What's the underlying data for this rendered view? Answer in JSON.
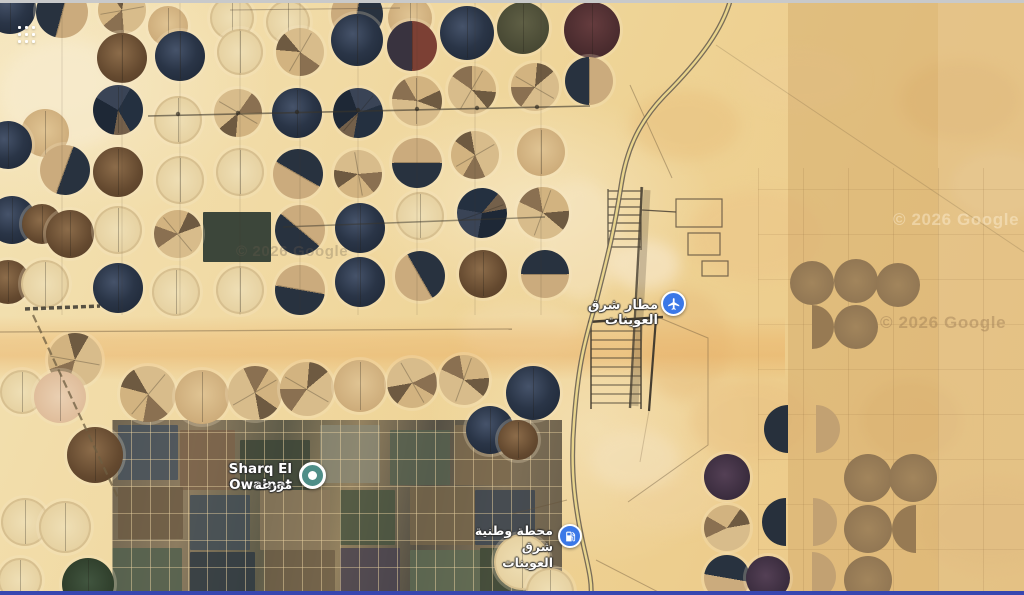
{
  "map": {
    "labels": {
      "farm_title": "Sharq El Owainat",
      "farm_subtitle_ar": "مزرعة",
      "airport_ar": "مطار شرق العوينات",
      "station_line1_ar": "محطة وطنية",
      "station_line2_ar": "شرق العوينات"
    },
    "attribution": "© 2026 Google",
    "colors": {
      "marker_blue": "#3b78e7",
      "marker_teal": "#4f8e88",
      "road_fill": "#e8d48c",
      "sand_base": "#f0d9a6",
      "bottom_bar": "#3847b0"
    },
    "circles": [
      [
        10,
        8,
        26,
        "navy",
        0
      ],
      [
        62,
        12,
        26,
        "half",
        15
      ],
      [
        122,
        10,
        24,
        "tanstreak",
        80
      ],
      [
        168,
        26,
        20,
        "tan",
        0
      ],
      [
        232,
        18,
        22,
        "pale",
        0
      ],
      [
        288,
        22,
        22,
        "pale",
        0
      ],
      [
        357,
        14,
        26,
        "half",
        190
      ],
      [
        410,
        18,
        22,
        "tan",
        0
      ],
      [
        467,
        33,
        27,
        "navy",
        0
      ],
      [
        523,
        28,
        26,
        "olive",
        0
      ],
      [
        592,
        30,
        28,
        "maroon",
        0
      ],
      [
        122,
        58,
        25,
        "brown",
        0
      ],
      [
        180,
        56,
        25,
        "navy",
        0
      ],
      [
        240,
        52,
        23,
        "pale",
        0
      ],
      [
        300,
        52,
        24,
        "tanstreak",
        30
      ],
      [
        357,
        40,
        26,
        "navy",
        0
      ],
      [
        412,
        46,
        25,
        "redhalf",
        0
      ],
      [
        472,
        90,
        24,
        "tanstreak",
        210
      ],
      [
        535,
        87,
        24,
        "tanstreak",
        120
      ],
      [
        589,
        81,
        24,
        "half",
        0
      ],
      [
        118,
        110,
        25,
        "navy2",
        0
      ],
      [
        178,
        120,
        24,
        "pale",
        0
      ],
      [
        238,
        113,
        24,
        "tanstreak",
        300
      ],
      [
        297,
        113,
        25,
        "navy",
        0
      ],
      [
        358,
        113,
        25,
        "navy2",
        40
      ],
      [
        417,
        101,
        25,
        "tanstreak",
        180
      ],
      [
        45,
        133,
        24,
        "tan",
        0
      ],
      [
        8,
        145,
        24,
        "navy",
        0
      ],
      [
        65,
        170,
        25,
        "half",
        200
      ],
      [
        118,
        172,
        25,
        "brown",
        0
      ],
      [
        180,
        180,
        24,
        "pale",
        0
      ],
      [
        240,
        172,
        24,
        "pale",
        0
      ],
      [
        298,
        174,
        25,
        "half",
        120
      ],
      [
        358,
        174,
        24,
        "tanstreak",
        350
      ],
      [
        417,
        163,
        25,
        "half",
        270
      ],
      [
        475,
        155,
        24,
        "tanstreak",
        60
      ],
      [
        541,
        152,
        24,
        "tan",
        0
      ],
      [
        12,
        220,
        24,
        "navy",
        0
      ],
      [
        42,
        224,
        20,
        "brown",
        0
      ],
      [
        70,
        234,
        24,
        "brown",
        0
      ],
      [
        118,
        230,
        24,
        "pale",
        0
      ],
      [
        178,
        234,
        24,
        "tanstreak",
        140
      ],
      [
        300,
        230,
        25,
        "half",
        310
      ],
      [
        360,
        228,
        25,
        "navy",
        0
      ],
      [
        420,
        216,
        24,
        "pale",
        0
      ],
      [
        482,
        213,
        25,
        "navy2",
        250
      ],
      [
        543,
        213,
        26,
        "tanstreak",
        200
      ],
      [
        8,
        282,
        22,
        "brown",
        0
      ],
      [
        45,
        284,
        24,
        "pale",
        0
      ],
      [
        118,
        288,
        25,
        "navy",
        0
      ],
      [
        176,
        292,
        24,
        "pale",
        0
      ],
      [
        240,
        290,
        24,
        "pale",
        0
      ],
      [
        300,
        290,
        25,
        "half",
        280
      ],
      [
        360,
        282,
        25,
        "navy",
        0
      ],
      [
        420,
        276,
        25,
        "half",
        150
      ],
      [
        483,
        274,
        24,
        "brown",
        0
      ],
      [
        545,
        274,
        24,
        "half",
        90
      ],
      [
        75,
        360,
        27,
        "tanstreak",
        100
      ],
      [
        22,
        392,
        22,
        "pale",
        0
      ],
      [
        60,
        397,
        26,
        "palepink",
        0
      ],
      [
        148,
        394,
        28,
        "tanstreak",
        40
      ],
      [
        202,
        397,
        27,
        "tan",
        0
      ],
      [
        255,
        393,
        27,
        "tanstreak",
        240
      ],
      [
        307,
        389,
        27,
        "tanstreak",
        120
      ],
      [
        360,
        386,
        26,
        "tan",
        0
      ],
      [
        412,
        383,
        25,
        "tanstreak",
        330
      ],
      [
        464,
        380,
        25,
        "tanstreak",
        200
      ],
      [
        95,
        455,
        28,
        "brown",
        0
      ],
      [
        25,
        522,
        24,
        "pale",
        0
      ],
      [
        65,
        527,
        26,
        "pale",
        0
      ],
      [
        20,
        580,
        22,
        "pale",
        0
      ],
      [
        88,
        584,
        26,
        "dgreen",
        0
      ],
      [
        533,
        393,
        27,
        "navy",
        0
      ],
      [
        490,
        430,
        24,
        "navy",
        0
      ],
      [
        518,
        440,
        20,
        "brown",
        0
      ],
      [
        522,
        562,
        28,
        "pale",
        0
      ],
      [
        550,
        592,
        24,
        "pale",
        0
      ],
      [
        727,
        477,
        23,
        "darkpurple",
        0
      ],
      [
        727,
        528,
        23,
        "tanstreak",
        150
      ],
      [
        727,
        578,
        23,
        "half",
        100
      ],
      [
        768,
        578,
        22,
        "darkpurple",
        0
      ],
      [
        788,
        429,
        24,
        "halfnavy",
        0
      ],
      [
        816,
        429,
        24,
        "halftan",
        0
      ],
      [
        786,
        522,
        24,
        "halfnavy",
        0
      ],
      [
        813,
        522,
        24,
        "halftan",
        0
      ],
      [
        812,
        576,
        24,
        "halftan",
        0
      ],
      [
        812,
        283,
        22,
        "rbrown",
        0
      ],
      [
        856,
        281,
        22,
        "rbrown",
        0
      ],
      [
        898,
        285,
        22,
        "rbrown",
        0
      ],
      [
        812,
        327,
        22,
        "halfrbrown",
        180
      ],
      [
        856,
        327,
        22,
        "rbrown",
        0
      ],
      [
        868,
        478,
        24,
        "rbrown",
        0
      ],
      [
        913,
        478,
        24,
        "rbrown",
        0
      ],
      [
        868,
        529,
        24,
        "rbrown",
        0
      ],
      [
        916,
        529,
        24,
        "halfrbrown",
        0
      ],
      [
        868,
        580,
        24,
        "rbrown",
        0
      ]
    ],
    "patches": [
      [
        203,
        212,
        68,
        50,
        "#2c3a31",
        0.92
      ],
      [
        118,
        425,
        60,
        55,
        "#44505c",
        0.8
      ],
      [
        180,
        430,
        55,
        60,
        "#7a6248",
        0.8
      ],
      [
        240,
        440,
        70,
        50,
        "#3a4436",
        0.8
      ],
      [
        320,
        425,
        60,
        58,
        "#8a8a77",
        0.75
      ],
      [
        390,
        430,
        60,
        55,
        "#55604f",
        0.8
      ],
      [
        455,
        425,
        55,
        60,
        "#7d6a4e",
        0.8
      ],
      [
        118,
        487,
        65,
        52,
        "#6b5a42",
        0.8
      ],
      [
        190,
        495,
        60,
        55,
        "#3f4b55",
        0.8
      ],
      [
        260,
        490,
        70,
        60,
        "#8c7a5c",
        0.75
      ],
      [
        340,
        490,
        55,
        55,
        "#46523e",
        0.8
      ],
      [
        410,
        487,
        65,
        58,
        "#75654a",
        0.8
      ],
      [
        475,
        490,
        60,
        55,
        "#394450",
        0.8
      ],
      [
        112,
        548,
        70,
        47,
        "#52604e",
        0.85
      ],
      [
        190,
        552,
        65,
        43,
        "#2f3a42",
        0.85
      ],
      [
        265,
        550,
        70,
        45,
        "#6e5e46",
        0.8
      ],
      [
        340,
        548,
        60,
        47,
        "#47414f",
        0.8
      ],
      [
        410,
        550,
        70,
        45,
        "#5d6a52",
        0.8
      ],
      [
        480,
        548,
        55,
        47,
        "#3c4836",
        0.85
      ]
    ],
    "blotches": [
      [
        630,
        90,
        110,
        70,
        "#e8c07e",
        0.5
      ],
      [
        690,
        190,
        130,
        90,
        "#ecc689",
        0.55
      ],
      [
        640,
        290,
        90,
        110,
        "#e6bb7a",
        0.45
      ],
      [
        740,
        50,
        120,
        60,
        "#eecf96",
        0.5
      ],
      [
        690,
        380,
        120,
        80,
        "#e9c183",
        0.5
      ],
      [
        620,
        470,
        100,
        60,
        "#efd29c",
        0.5
      ],
      [
        900,
        60,
        120,
        80,
        "#e4b977",
        0.4
      ],
      [
        950,
        150,
        100,
        70,
        "#f2d7a5",
        0.5
      ],
      [
        0,
        40,
        130,
        110,
        "#f8ecd0",
        0.6
      ],
      [
        540,
        180,
        80,
        120,
        "#f6e6c4",
        0.5
      ],
      [
        610,
        240,
        70,
        50,
        "#f8ead0",
        0.6
      ],
      [
        590,
        430,
        90,
        60,
        "#f4e2bd",
        0.55
      ],
      [
        460,
        300,
        120,
        60,
        "#f3ddb0",
        0.5
      ],
      [
        860,
        380,
        100,
        80,
        "#e2b678",
        0.35
      ],
      [
        920,
        480,
        140,
        90,
        "#e7c083",
        0.4
      ]
    ]
  }
}
